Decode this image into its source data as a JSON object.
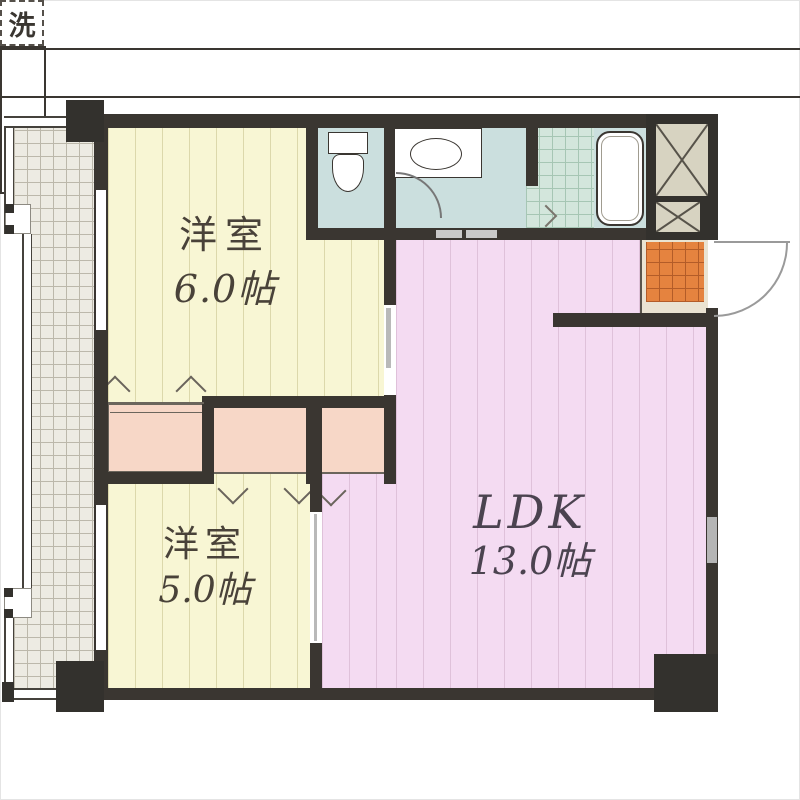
{
  "plan": {
    "type": "apartment-floor-plan",
    "layout_name": "2LDK",
    "rooms": [
      {
        "id": "bedroom-1",
        "name": "洋室",
        "size": "6.0帖"
      },
      {
        "id": "bedroom-2",
        "name": "洋室",
        "size": "5.0帖"
      },
      {
        "id": "ldk",
        "name": "LDK",
        "size": "13.0帖"
      }
    ],
    "laundry_label": "洗",
    "fixtures": [
      "toilet",
      "washbasin",
      "washing-machine-space",
      "bathtub",
      "kitchen-counter",
      "entrance-door",
      "balcony",
      "pipe-shafts",
      "closets"
    ],
    "colors": {
      "wall": "#3a3631",
      "bedroom_floor": "#f8f6d4",
      "ldk_floor": "#f4dbf2",
      "sanitary_floor": "#cbdfde",
      "bath_tile": "#d3e6dc",
      "entrance_floor": "#e5833f",
      "closet": "#f7d7c7",
      "balcony_floor": "#edebe3",
      "shaft_box": "#d7d3c1"
    }
  }
}
